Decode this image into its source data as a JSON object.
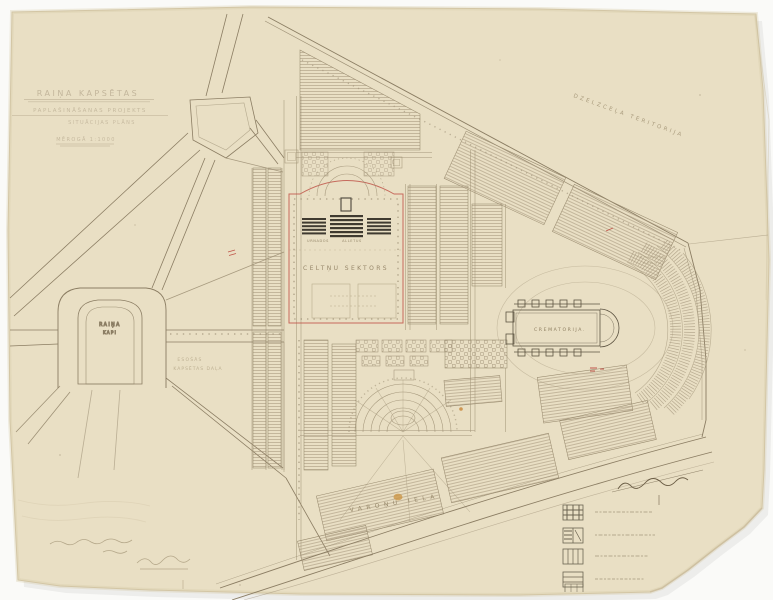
{
  "drawing": {
    "title_block": {
      "line1": "RAIŅA KAPSĒTAS",
      "line2": "PAPLAŠINĀŠANAS PROJEKTS",
      "line3": "SITUĀCIJAS PLĀNS",
      "line4": "MĒROGĀ 1:1000"
    },
    "labels": {
      "territory": "DZELZCEĻA TERITORIJA",
      "crematoria": "CREMATORIJA.",
      "sector": "CELTŅU SEKTORS",
      "sector_small_left": "URNADOS",
      "sector_small_right": "ALLETUS",
      "loop_line1": "RAIŅA",
      "loop_line2": "KAPI",
      "existing_line1": "ESOŠĀS",
      "existing_line2": "KAPSĒTAS DAĻA",
      "street": "VAROŅU IELA"
    },
    "legend": {
      "items": [
        {
          "symbol": "dense-crosshatch-plot"
        },
        {
          "symbol": "half-hatch-plot"
        },
        {
          "symbol": "vertical-rows-plot"
        },
        {
          "symbol": "horizontal-rows-plot"
        }
      ]
    },
    "colors": {
      "paper": "#e9dfc4",
      "ink": "#8b7d63",
      "dark_ink": "#4a443a",
      "red_accent": "#c0564a",
      "orange_stain": "#c9913f",
      "background": "#fafaf8"
    }
  }
}
